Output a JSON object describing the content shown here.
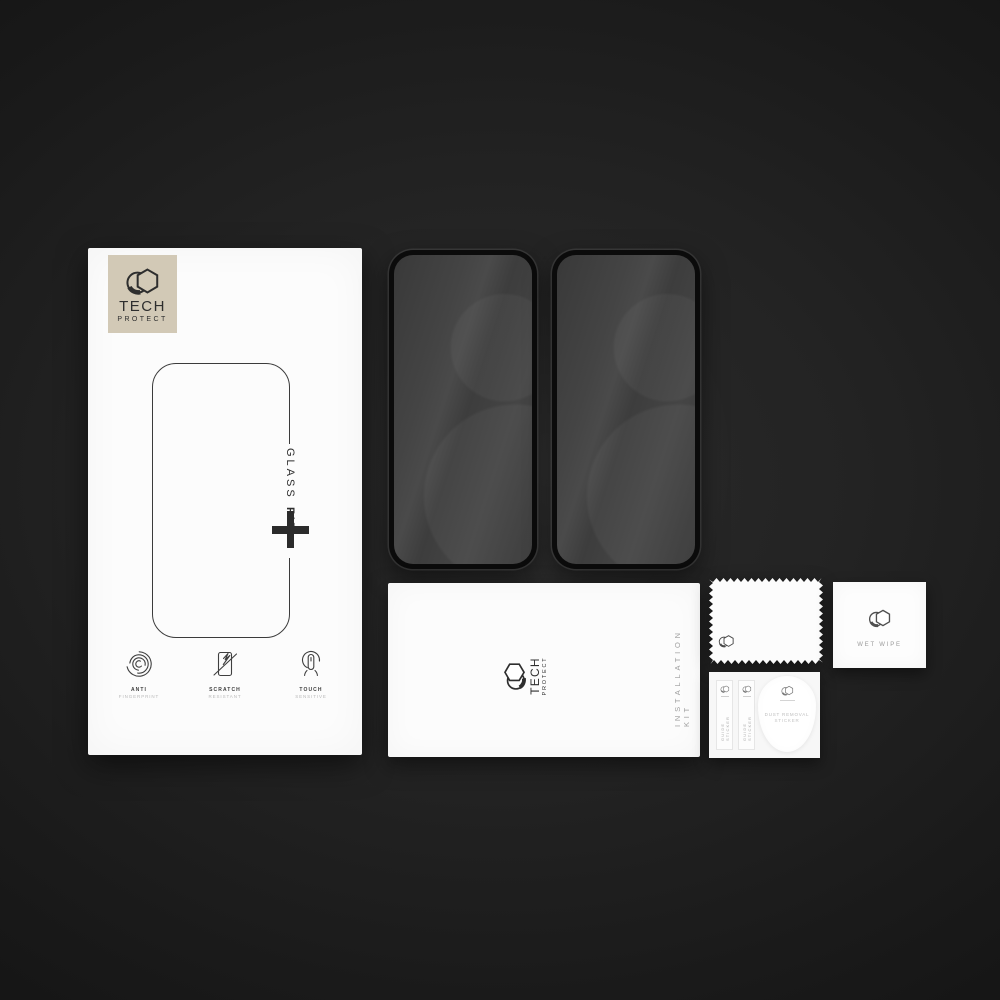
{
  "colors": {
    "background": "#1a1a1a",
    "box_white": "#fcfcfc",
    "logo_beige": "#d2c9b6",
    "glass_frame_black": "#0b0b0b",
    "glass_screen_gray": "#414141",
    "text_dark": "#2e2e2e",
    "text_gray": "#9c9c9c"
  },
  "brand": {
    "word1": "TECH",
    "word2": "PROTECT"
  },
  "retail_box": {
    "side_label": {
      "regular": "GLASS",
      "bold": "FIT"
    },
    "features": [
      {
        "icon": "anti-fingerprint-icon",
        "line1": "ANTI",
        "line2": "FINGERPRINT"
      },
      {
        "icon": "scratch-resistant-icon",
        "line1": "SCRATCH",
        "line2": "RESISTANT"
      },
      {
        "icon": "touch-sensitive-icon",
        "line1": "TOUCH",
        "line2": "SENSITIVE"
      }
    ]
  },
  "glass_protectors": {
    "count": 2
  },
  "installation_kit": {
    "side_label": "INSTALLATION KIT"
  },
  "accessories": {
    "wet_wipe": {
      "label": "WET WIPE"
    },
    "guide_stickers": [
      {
        "label": "GUIDE STICKER"
      },
      {
        "label": "GUIDE STICKER"
      }
    ],
    "dust_removal_sticker": {
      "line1": "DUST REMOVAL",
      "line2": "STICKER"
    }
  },
  "icons": {
    "hexagon-logo-icon": "hexagon overlapping circle",
    "plus-icon": "+",
    "anti-fingerprint-icon": "fingerprint whorl",
    "scratch-resistant-icon": "screen with diagonal scratch",
    "touch-sensitive-icon": "fingertip in halo"
  }
}
